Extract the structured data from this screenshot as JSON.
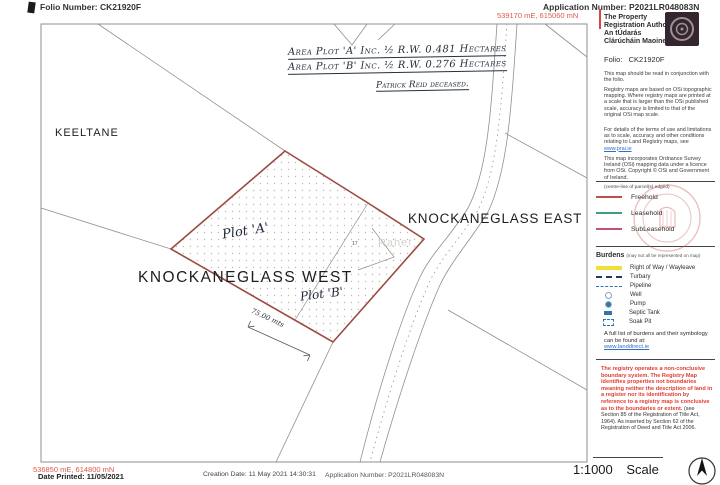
{
  "header": {
    "folio_number": "Folio Number: CK21920F",
    "application_number": "Application Number: P2021LR048083N",
    "top_coordinates": "539170 mE, 615060 mN"
  },
  "handwritten": {
    "area_plot_a": "Area Plot 'A' Inc. ½ R.W. 0.481 Hectares",
    "area_plot_b": "Area Plot 'B' Inc. ½ R.W. 0.276 Hectares",
    "note": "Patrick Reid deceased.",
    "plot_a": "Plot 'A'",
    "plot_b": "Plot 'B'",
    "dimension": "75.00 mts"
  },
  "map": {
    "townland_left": "KEELTANE",
    "townland_east": "KNOCKANEGLASS EAST",
    "townland_west": "KNOCKANEGLASS WEST",
    "parcel_number": "17",
    "faint_label": "Raher",
    "boundary_color": "#9c4a42"
  },
  "sidebar": {
    "authority_en": "The Property Registration Authority",
    "authority_ga": "An tÚdarás Clárúcháin Maoine",
    "folio_label": "Folio:",
    "folio_value": "CK21920F",
    "read_note": "This map should be read in conjunction with the folio.",
    "osi_note": "Registry maps are based on OSi topographic mapping. Where registry maps are printed at a scale that is larger than the OSi published scale, accuracy is limited to that of the original OSi map scale.",
    "terms_note": "For details of the terms of use and limitations as to scale, accuracy and other conditions relating to Land Registry maps, see",
    "terms_link": "www.prai.ie",
    "copyright_note": "This map incorporates Ordnance Survey Ireland (OSi) mapping data under a licence from OSi. Copyright © OSi and Government of Ireland.",
    "legend_caption": "(centre-line of parcel(s) edged)",
    "legend": [
      {
        "label": "Freehold",
        "color": "#c0504d"
      },
      {
        "label": "Leasehold",
        "color": "#3f9e7c"
      },
      {
        "label": "SubLeasehold",
        "color": "#c0507f"
      }
    ],
    "burdens_title": "Burdens",
    "burdens_caption": "(may not all be represented on map)",
    "burdens": [
      {
        "label": "Right of Way / Wayleave",
        "color": "#efe13c"
      },
      {
        "label": "Turbary",
        "color": "#1c3a63"
      },
      {
        "label": "Pipeline",
        "color": "#2e74b5"
      },
      {
        "label": "Well",
        "color": "#2e74b5"
      },
      {
        "label": "Pump",
        "color": "#2e74b5"
      },
      {
        "label": "Septic Tank",
        "color": "#2e74b5"
      },
      {
        "label": "Soak Pit",
        "color": "#2e74b5"
      }
    ],
    "burdens_footer": "A full list of burdens and their symbology can be found at:",
    "burdens_link": "www.landdirect.ie",
    "warning_red": "The registry operates a non-conclusive boundary system. The Registry Map identifies properties not boundaries meaning neither the description of land in a register nor its identification by reference to a registry map is conclusive as to the boundaries or extent. ",
    "warning_black": "(see Section 85 of the Registration of Title Act, 1964). As inserted by Section 62 of the Registration of Deed and Title Act 2006."
  },
  "footer": {
    "bottom_coordinates": "536850 mE, 614800 mN",
    "date_printed": "Date Printed: 11/05/2021",
    "creation_date": "Creation Date: 11 May 2021 14:30:31",
    "application_number": "Application Number: P2021LR048083N",
    "scale_ratio": "1:1000",
    "scale_label": "Scale"
  },
  "colors": {
    "coordinate_red": "#dd5a4b",
    "warning_red": "#e03c31",
    "link_blue": "#2f6fc4",
    "plot_boundary": "#9c4a42"
  }
}
